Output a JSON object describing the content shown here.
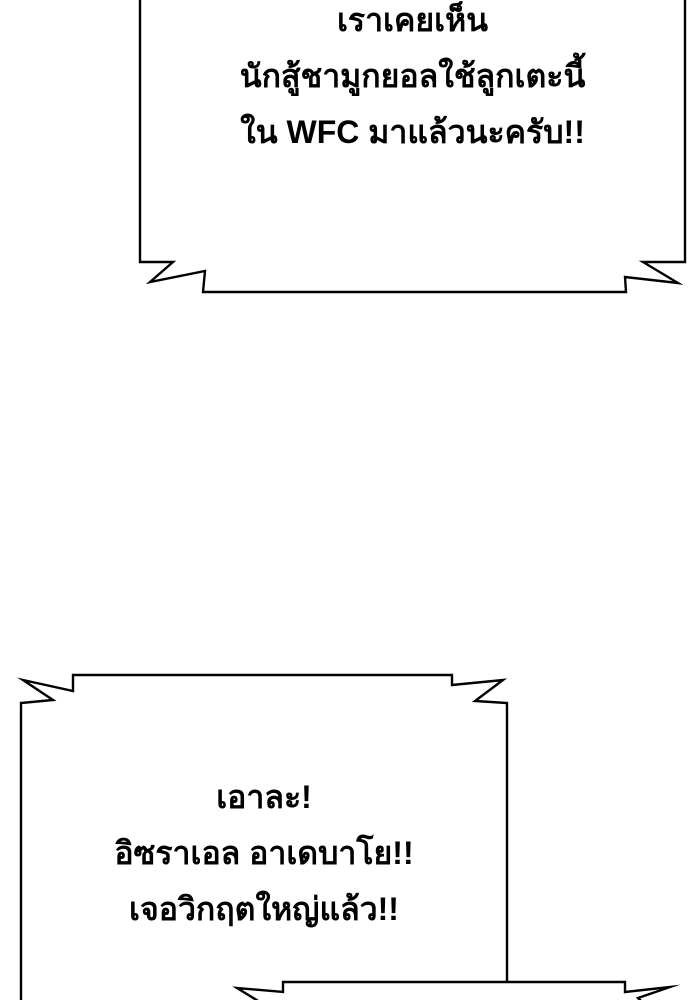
{
  "page": {
    "background": "#ffffff",
    "ink": "#000000",
    "kind": "comic-panel"
  },
  "bubbles": [
    {
      "id": "bubble-top",
      "style": "shout-banner, bottom zigzag corners, top edge cut off by panel",
      "lines": [
        "เราเคยเห็น",
        "นักสู้ชามูกยอลใช้ลูกเตะนี้",
        "ใน WFC มาแล้วนะครับ!!"
      ]
    },
    {
      "id": "bubble-middle",
      "style": "shout-banner, top zigzag corners, bottom edge cut off by panel",
      "lines": [
        "เอาละ!",
        "อิซราเอล อาเดบาโย!!",
        "เจอวิกฤตใหญ่แล้ว!!"
      ]
    },
    {
      "id": "bubble-bottom-cut",
      "style": "shout-banner, only top zigzag edge visible at panel bottom",
      "lines": []
    }
  ]
}
